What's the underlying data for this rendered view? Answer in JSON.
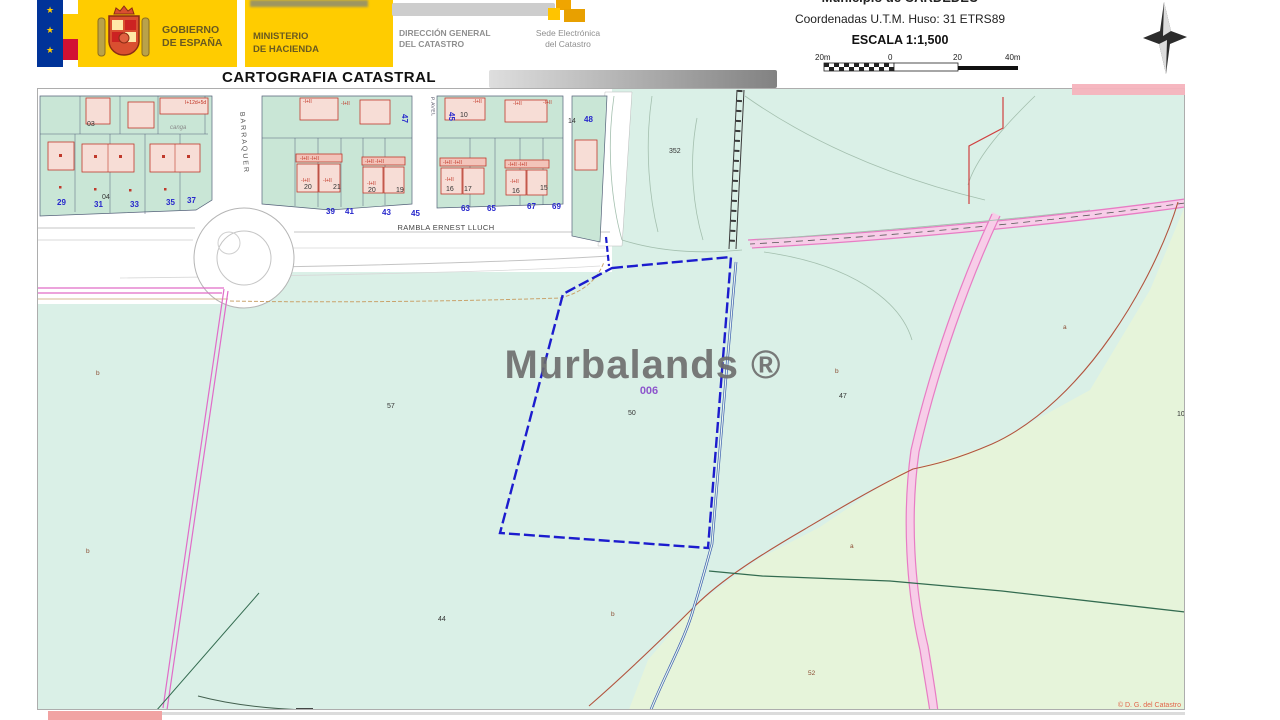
{
  "header": {
    "logo_gobierno_line1": "GOBIERNO",
    "logo_gobierno_line2": "DE ESPAÑA",
    "ministerio_line1": "MINISTERIO",
    "ministerio_line2": "DE HACIENDA",
    "dgc_line1": "DIRECCIÓN GENERAL",
    "dgc_line2": "DEL CATASTRO",
    "sede_line1": "Sede Electrónica",
    "sede_line2": "del Catastro",
    "title": "CARTOGRAFIA CATASTRAL",
    "municipio": "Municipio de CARDEDEU",
    "coordenadas": "Coordenadas U.T.M. Huso: 31 ETRS89",
    "escala": "ESCALA 1:1,500",
    "scalebar_labels": [
      "20m",
      "0",
      "20",
      "40m"
    ],
    "flag_stars": "★\n★\n★"
  },
  "map": {
    "watermark": "Murbalands ®",
    "parcel_ref": "006",
    "streets": {
      "rambla": "RAMBLA ERNEST LLUCH",
      "barraquer": "BARRAQUER",
      "passage": "P.AVEL"
    },
    "copyright": "© D. G. del Catastro",
    "labels": [
      {
        "t": "29",
        "x": 57,
        "y": 205,
        "c": "blue"
      },
      {
        "t": "31",
        "x": 94,
        "y": 207,
        "c": "blue"
      },
      {
        "t": "33",
        "x": 130,
        "y": 207,
        "c": "blue"
      },
      {
        "t": "35",
        "x": 166,
        "y": 205,
        "c": "blue"
      },
      {
        "t": "37",
        "x": 187,
        "y": 203,
        "c": "blue"
      },
      {
        "t": "39",
        "x": 326,
        "y": 214,
        "c": "blue"
      },
      {
        "t": "41",
        "x": 345,
        "y": 214,
        "c": "blue"
      },
      {
        "t": "43",
        "x": 382,
        "y": 215,
        "c": "blue"
      },
      {
        "t": "45",
        "x": 411,
        "y": 216,
        "c": "blue"
      },
      {
        "t": "63",
        "x": 461,
        "y": 211,
        "c": "blue"
      },
      {
        "t": "65",
        "x": 487,
        "y": 211,
        "c": "blue"
      },
      {
        "t": "67",
        "x": 527,
        "y": 209,
        "c": "blue"
      },
      {
        "t": "69",
        "x": 552,
        "y": 209,
        "c": "blue"
      },
      {
        "t": "48",
        "x": 584,
        "y": 122,
        "c": "blue"
      },
      {
        "t": "47",
        "x": 402,
        "y": 114,
        "c": "blue",
        "r": 90
      },
      {
        "t": "45",
        "x": 449,
        "y": 112,
        "c": "blue",
        "r": 90
      },
      {
        "t": "03",
        "x": 87,
        "y": 126,
        "c": "dark"
      },
      {
        "t": "04",
        "x": 102,
        "y": 199,
        "c": "dark"
      },
      {
        "t": "10",
        "x": 460,
        "y": 117,
        "c": "dark"
      },
      {
        "t": "14",
        "x": 568,
        "y": 123,
        "c": "dark"
      },
      {
        "t": "20",
        "x": 304,
        "y": 189,
        "c": "dark"
      },
      {
        "t": "21",
        "x": 333,
        "y": 189,
        "c": "dark"
      },
      {
        "t": "20",
        "x": 368,
        "y": 192,
        "c": "dark"
      },
      {
        "t": "19",
        "x": 396,
        "y": 192,
        "c": "dark"
      },
      {
        "t": "16",
        "x": 446,
        "y": 191,
        "c": "dark"
      },
      {
        "t": "17",
        "x": 464,
        "y": 191,
        "c": "dark"
      },
      {
        "t": "16",
        "x": 512,
        "y": 193,
        "c": "dark"
      },
      {
        "t": "15",
        "x": 540,
        "y": 190,
        "c": "dark"
      },
      {
        "t": "352",
        "x": 669,
        "y": 153,
        "c": "dark"
      },
      {
        "t": "57",
        "x": 387,
        "y": 408,
        "c": "dark"
      },
      {
        "t": "50",
        "x": 628,
        "y": 415,
        "c": "dark"
      },
      {
        "t": "47",
        "x": 839,
        "y": 398,
        "c": "dark"
      },
      {
        "t": "10",
        "x": 1177,
        "y": 416,
        "c": "dark"
      },
      {
        "t": "44",
        "x": 438,
        "y": 621,
        "c": "dark"
      },
      {
        "t": "b",
        "x": 96,
        "y": 375,
        "c": "letter"
      },
      {
        "t": "b",
        "x": 86,
        "y": 553,
        "c": "letter"
      },
      {
        "t": "b",
        "x": 835,
        "y": 373,
        "c": "letter"
      },
      {
        "t": "a",
        "x": 1063,
        "y": 329,
        "c": "letter"
      },
      {
        "t": "a",
        "x": 850,
        "y": 548,
        "c": "letter"
      },
      {
        "t": "b",
        "x": 611,
        "y": 616,
        "c": "letter"
      },
      {
        "t": "52",
        "x": 808,
        "y": 675,
        "c": "letter"
      },
      {
        "t": "I+12d+5d",
        "x": 185,
        "y": 104,
        "c": "redlbl"
      },
      {
        "t": "-I+II",
        "x": 303,
        "y": 103,
        "c": "redlbl"
      },
      {
        "t": "-I+II",
        "x": 341,
        "y": 105,
        "c": "redlbl"
      },
      {
        "t": "-I+II",
        "x": 473,
        "y": 103,
        "c": "redlbl"
      },
      {
        "t": "-I+II",
        "x": 513,
        "y": 105,
        "c": "redlbl"
      },
      {
        "t": "-I+II",
        "x": 543,
        "y": 104,
        "c": "redlbl"
      },
      {
        "t": "-I+II -I+II",
        "x": 300,
        "y": 160,
        "c": "redlbl"
      },
      {
        "t": "-I+II -I+II",
        "x": 365,
        "y": 163,
        "c": "redlbl"
      },
      {
        "t": "-I+II -I+II",
        "x": 443,
        "y": 164,
        "c": "redlbl"
      },
      {
        "t": "-I+II -I+II",
        "x": 508,
        "y": 166,
        "c": "redlbl"
      },
      {
        "t": "-I+II",
        "x": 301,
        "y": 182,
        "c": "redlbl"
      },
      {
        "t": "-I+II",
        "x": 323,
        "y": 182,
        "c": "redlbl"
      },
      {
        "t": "-I+II",
        "x": 367,
        "y": 185,
        "c": "redlbl"
      },
      {
        "t": "-I+II",
        "x": 445,
        "y": 181,
        "c": "redlbl"
      },
      {
        "t": "-I+II",
        "x": 510,
        "y": 183,
        "c": "redlbl"
      },
      {
        "t": "canga",
        "x": 170,
        "y": 129,
        "c": "gray"
      }
    ]
  },
  "colors": {
    "parcel_blue": "#1c1cce",
    "road_pink": "#e87cc4",
    "boundary_magenta": "#e06cc8",
    "mint_green": "#daf0e7",
    "pale_green": "#e6f4da",
    "block_green": "#c9e6d6",
    "building_pink": "#f7ddd6",
    "building_red": "#c0392b",
    "gov_yellow": "#ffcc00",
    "redaction_pink": "#f1a3a3"
  }
}
